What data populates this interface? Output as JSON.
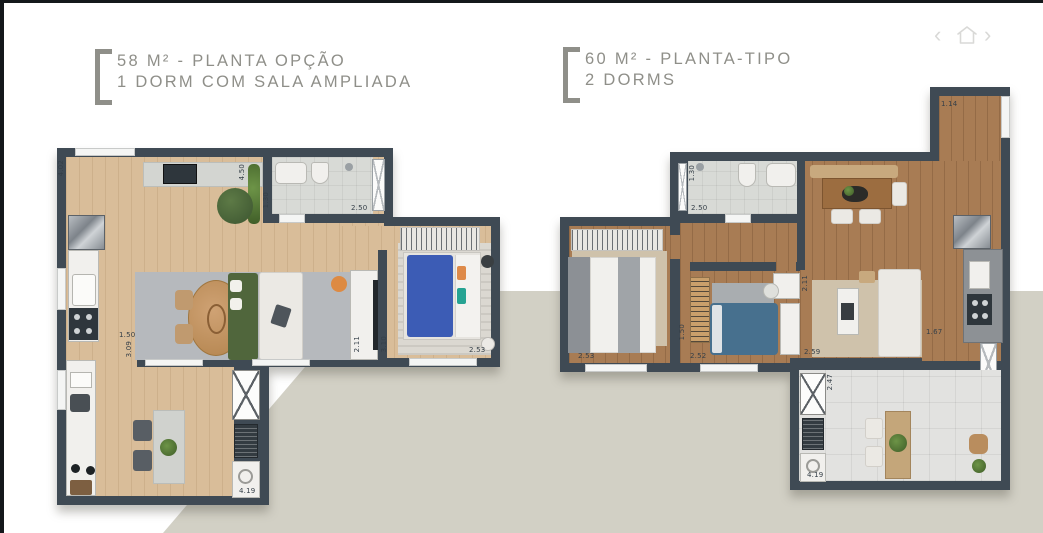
{
  "nav": {
    "prev_label": "‹",
    "next_label": "›"
  },
  "plans": [
    {
      "title_line1": "58 M² - PLANTA OPÇÃO",
      "title_line2": "1 DORM COM SALA AMPLIADA",
      "dims": {
        "entry_wall": "4.02",
        "kitchen_top": "4.50",
        "bath_depth": "1.30",
        "bath_width": "2.50",
        "living_left": "1.50",
        "living_depth": "3.09",
        "desk_wall": "2.11",
        "bedroom_depth": "3.10",
        "bedroom_width": "2.53",
        "service_width": "4.19"
      }
    },
    {
      "title_line1": "60 M² - PLANTA-TIPO",
      "title_line2": "2 DORMS",
      "dims": {
        "entry_width": "1.14",
        "bath_depth": "1.30",
        "bath_width": "2.50",
        "bedroom1_width": "2.53",
        "bedroom2_depth": "1.50",
        "bedroom2_width": "2.52",
        "desk_wall": "2.11",
        "living_width": "2.59",
        "balcony_depth": "2.47",
        "kitchen_width": "1.67",
        "service_width": "4.19"
      }
    }
  ]
}
